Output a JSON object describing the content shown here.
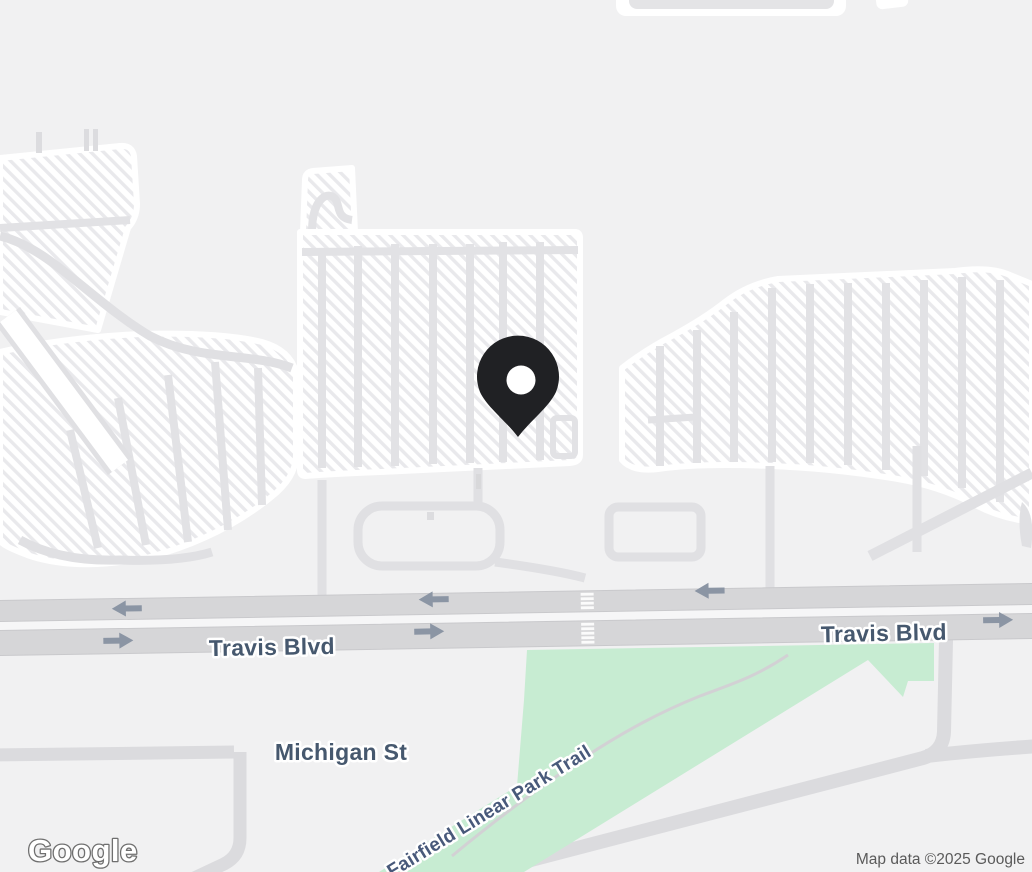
{
  "map": {
    "provider": {
      "logo_text": "Google"
    },
    "attribution": "Map data ©2025 Google",
    "labels": {
      "road_primary": "Travis Blvd",
      "road_secondary": "Michigan St",
      "trail": "Fairfield Linear Park Trail"
    },
    "marker": {
      "name": "location-pin",
      "color": "#202124",
      "hole_color": "#ffffff"
    },
    "colors": {
      "background": "#f1f1f2",
      "parking_fill": "#ffffff",
      "parking_hatch": "#e9e9ec",
      "lot_lines": "#e2e2e5",
      "road_major": "#d6d6d8",
      "road_major_edge": "#c9c9cc",
      "road_median": "#f6f6f7",
      "road_minor": "#dbdbde",
      "park_green": "#c7ecd2",
      "trail_line": "#d2d1d4",
      "arrow": "#8b95a4",
      "label_road": "#46586e",
      "label_trail": "#48597a",
      "attribution_text": "#5a5a5a"
    }
  }
}
